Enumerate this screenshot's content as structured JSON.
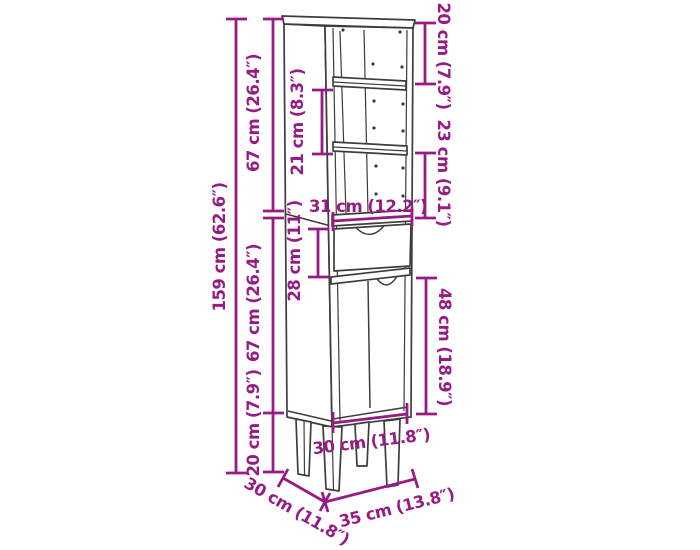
{
  "diagram": {
    "type": "furniture-dimension-drawing",
    "item": "tall cabinet with three open shelves, one drawer, door front and four legs",
    "colors": {
      "dimension_color": "#981b85",
      "outline_color": "#3d3d3c",
      "background": "#ffffff"
    },
    "labels": {
      "total_height": "159 cm (62.6″)",
      "upper_section_height": "67 cm (26.4″)",
      "lower_section_height": "67 cm (26.4″)",
      "leg_height": "20 cm (7.9″)",
      "top_compartment_height": "20 cm (7.9″)",
      "middle_compartment_height": "21 cm (8.3″)",
      "bottom_compartment_height": "23 cm (9.1″)",
      "drawer_front_height": "28 cm (11″)",
      "door_height": "48 cm (18.9″)",
      "inner_width": "31 cm (12.2″)",
      "base_width": "30 cm (11.8″)",
      "depth": "30 cm (11.8″)",
      "overall_width": "35 cm (13.8″)"
    }
  }
}
